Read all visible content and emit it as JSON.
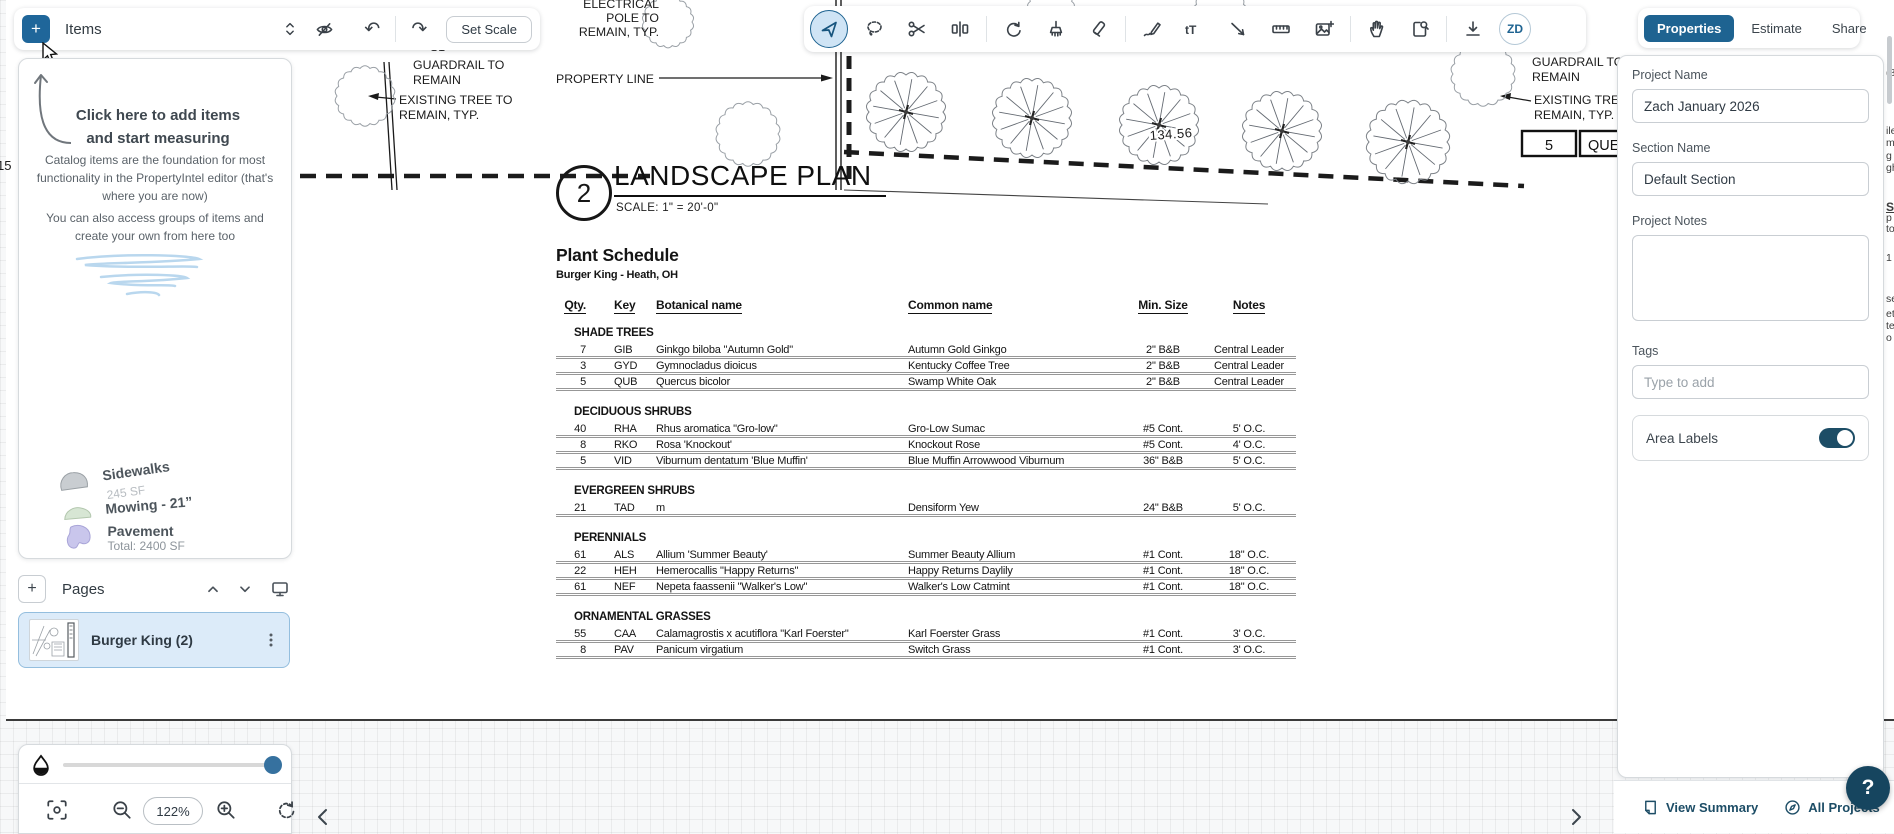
{
  "toolbar_left": {
    "items_label": "Items",
    "set_scale_label": "Set Scale"
  },
  "tabs": {
    "properties": "Properties",
    "estimate": "Estimate",
    "share": "Share"
  },
  "avatar": "ZD",
  "items_panel": {
    "headline": "Click here to add items and start measuring",
    "para1": "Catalog items are the foundation for most functionality in the PropertyIntel editor (that's where you are now)",
    "para2": "You can also access groups of items and create your own from here too",
    "samples": {
      "sidewalks": "Sidewalks",
      "sidewalks_detail": "245 SF",
      "mowing": "Mowing - 21”",
      "pavement": "Pavement",
      "pavement_detail": "Total: 2400 SF"
    }
  },
  "pages": {
    "title": "Pages",
    "page_name": "Burger King (2)"
  },
  "zoom": {
    "level": "122%"
  },
  "panel": {
    "project_name_label": "Project Name",
    "project_name_value": "Zach January 2026",
    "section_name_label": "Section Name",
    "section_name_value": "Default Section",
    "notes_label": "Project Notes",
    "tags_label": "Tags",
    "tags_placeholder": "Type to add",
    "area_labels_label": "Area Labels"
  },
  "footer": {
    "view_summary": "View Summary",
    "all_projects": "All Projects",
    "help": "?"
  },
  "colors": {
    "brand_blue": "#1e6391",
    "navy": "#1d4d66",
    "selected_page_bg": "#dcebf9"
  },
  "drawing": {
    "title_block": {
      "number": "2",
      "title": "LANDSCAPE PLAN",
      "scale": "SCALE:  1\" = 20'-0\""
    },
    "dimension": "134.56",
    "annotations": {
      "electrical": [
        "ELECTRICAL",
        "POLE TO",
        "REMAIN, TYP."
      ],
      "s1": "S1",
      "guardrail_left": [
        "GUARDRAIL TO",
        "REMAIN"
      ],
      "existing_left": [
        "EXISTING TREE TO",
        "REMAIN, TYP."
      ],
      "property_line": "PROPERTY LINE",
      "guardrail_right": [
        "GUARDRAIL TO",
        "REMAIN"
      ],
      "existing_right": [
        "EXISTING TREE",
        "REMAIN, TYP."
      ],
      "left_edge": "15",
      "cell_qty": "5",
      "cell_key": "QUE"
    },
    "schedule": {
      "title": "Plant Schedule",
      "subtitle": "Burger King - Heath, OH",
      "columns": [
        "Qty.",
        "Key",
        "Botanical name",
        "Common name",
        "Min. Size",
        "Notes"
      ],
      "groups": [
        {
          "name": "SHADE TREES",
          "rows": [
            [
              "7",
              "GIB",
              "Ginkgo biloba \"Autumn Gold\"",
              "Autumn Gold Ginkgo",
              "2\" B&B",
              "Central Leader"
            ],
            [
              "3",
              "GYD",
              "Gymnocladus dioicus",
              "Kentucky Coffee Tree",
              "2\" B&B",
              "Central Leader"
            ],
            [
              "5",
              "QUB",
              "Quercus bicolor",
              "Swamp White Oak",
              "2\" B&B",
              "Central Leader"
            ]
          ]
        },
        {
          "name": "DECIDUOUS SHRUBS",
          "rows": [
            [
              "40",
              "RHA",
              "Rhus aromatica \"Gro-low\"",
              "Gro-Low Sumac",
              "#5 Cont.",
              "5' O.C."
            ],
            [
              "8",
              "RKO",
              "Rosa 'Knockout'",
              "Knockout Rose",
              "#5 Cont.",
              "4' O.C."
            ],
            [
              "5",
              "VID",
              "Viburnum dentatum 'Blue Muffin'",
              "Blue Muffin Arrowwood Viburnum",
              "36\" B&B",
              "5' O.C."
            ]
          ]
        },
        {
          "name": "EVERGREEN SHRUBS",
          "rows": [
            [
              "21",
              "TAD",
              "m",
              "Densiform Yew",
              "24\" B&B",
              "5' O.C."
            ]
          ]
        },
        {
          "name": "PERENNIALS",
          "rows": [
            [
              "61",
              "ALS",
              "Allium 'Summer Beauty'",
              "Summer Beauty Allium",
              "#1 Cont.",
              "18\" O.C."
            ],
            [
              "22",
              "HEH",
              "Hemerocallis \"Happy Returns\"",
              "Happy Returns Daylily",
              "#1 Cont.",
              "18\" O.C."
            ],
            [
              "61",
              "NEF",
              "Nepeta faassenii \"Walker's Low\"",
              "Walker's Low Catmint",
              "#1 Cont.",
              "18\" O.C."
            ]
          ]
        },
        {
          "name": "ORNAMENTAL GRASSES",
          "rows": [
            [
              "55",
              "CAA",
              "Calamagrostis x acutiflora \"Karl Foerster\"",
              "Karl Foerster Grass",
              "#1 Cont.",
              "3' O.C."
            ],
            [
              "8",
              "PAV",
              "Panicum virgatium",
              "Switch Grass",
              "#1 Cont.",
              "3' O.C."
            ]
          ]
        }
      ]
    },
    "edge_fragments": [
      [
        "(8",
        67
      ],
      [
        "ile",
        125
      ],
      [
        "m",
        137
      ],
      [
        "g",
        150
      ],
      [
        "gh",
        162
      ],
      [
        "S",
        200,
        "bu"
      ],
      [
        "p",
        212
      ],
      [
        "to",
        223
      ],
      [
        "1",
        252
      ],
      [
        "se",
        293
      ],
      [
        "et",
        308
      ],
      [
        "te",
        320
      ],
      [
        "o",
        332
      ]
    ]
  }
}
